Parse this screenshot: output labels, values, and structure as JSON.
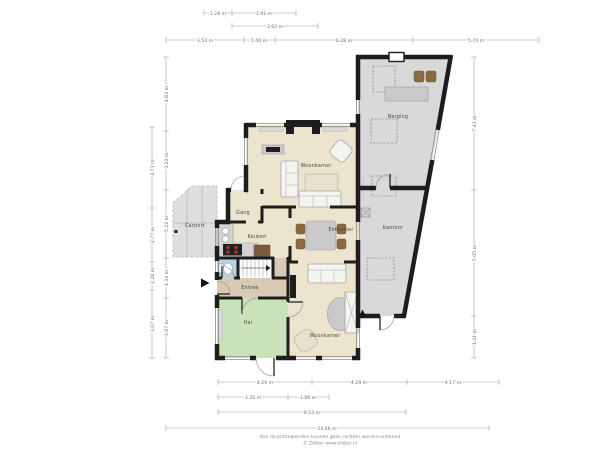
{
  "rooms": {
    "woonkamer_top": "Woonkamer",
    "eetkamer": "Eetkamer",
    "keuken": "Keuken",
    "gang": "Gang",
    "entree": "Entree",
    "hal": "Hal",
    "woonkamer_bottom": "Woonkamer",
    "kantoor": "Kantoor",
    "berging": "Berging",
    "carport": "Carport"
  },
  "dimensions": {
    "top_row1": [
      "1.28 m",
      "2.91 m"
    ],
    "top_row2": [
      "3.92 m"
    ],
    "top_row3": [
      "3.53 m",
      "1.40 m",
      "6.28 m",
      "5.74 m"
    ],
    "bottom_row1": [
      "4.29 m",
      "4.29 m",
      "4.17 m"
    ],
    "bottom_row2": [
      "3.20 m",
      "1.88 m"
    ],
    "bottom_row3": [
      "8.53 m"
    ],
    "bottom_row4": [
      "14.66 m"
    ],
    "left_outer": [
      "4.71 m",
      "2.77 m",
      "2.28 m",
      "3.07 m"
    ],
    "left_inner": [
      "4.83 m",
      "3.22 m",
      "5.22 m",
      "1.34 m",
      "3.07 m"
    ],
    "right": [
      "7.43 m",
      "5.05 m",
      "1.41 m"
    ]
  },
  "footer": {
    "disclaimer": "Aan de plattegronden kunnen geen rechten worden ontleend",
    "copyright": "© Zibber www.zibber.nl"
  },
  "icons": {
    "entrance_front": "arrow-right-triangle",
    "entrance_rear": "arrow-up-triangle"
  },
  "colors": {
    "floor_main": "#ece4cf",
    "floor_hal": "#c9e2ba",
    "floor_gray": "#d9d9d9",
    "floor_entree": "#d8c9b4",
    "floor_toilet": "#b9d2e2",
    "wall": "#1d1d1d",
    "dimension": "#9a9a9a"
  }
}
